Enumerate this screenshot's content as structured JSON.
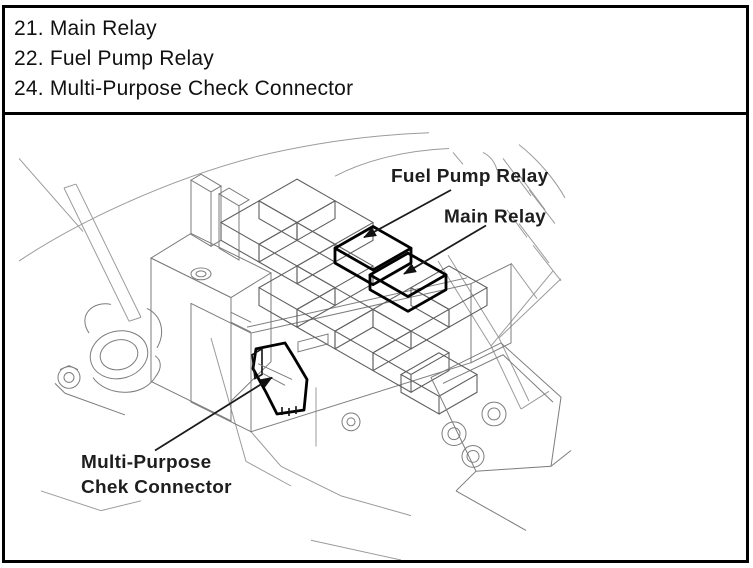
{
  "parts_list": {
    "items": [
      "21. Main Relay",
      "22. Fuel Pump Relay",
      "24. Multi-Purpose Check Connector"
    ]
  },
  "diagram": {
    "labels": {
      "fuel_pump_relay": "Fuel Pump Relay",
      "main_relay": "Main Relay",
      "check_connector_line1": "Multi-Purpose",
      "check_connector_line2": "Chek Connector"
    },
    "style": {
      "sketch_line_color": "#9b9b9b",
      "highlight_color": "#000000",
      "arrow_color": "#1c1c1c",
      "border_color": "#000000"
    }
  }
}
